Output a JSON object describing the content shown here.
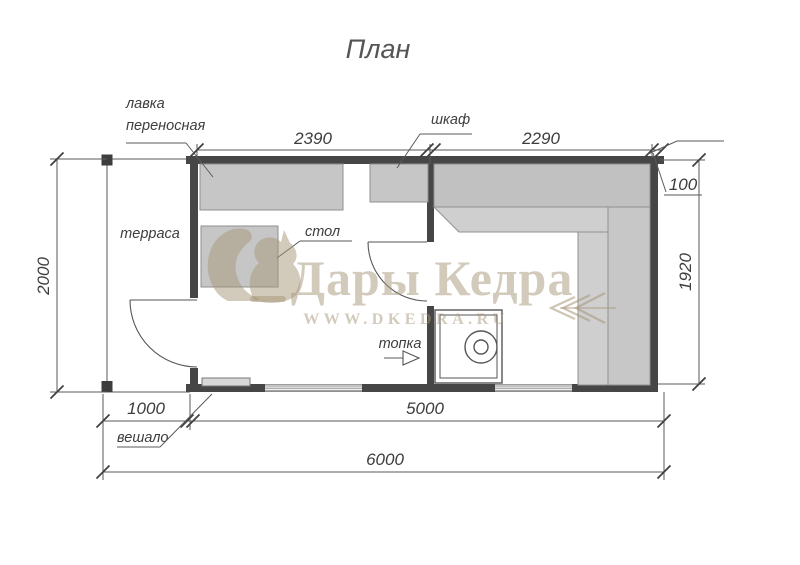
{
  "title": "План",
  "watermark": {
    "brand": "Дары Кедра",
    "site": "WWW.DKEDRA.RU",
    "color": "#a69578"
  },
  "rooms": {
    "terrace": "терраса"
  },
  "annotations": {
    "bench": {
      "line1": "лавка",
      "line2": "переносная"
    },
    "cabinet": "шкаф",
    "table": "стол",
    "firebox": "топка",
    "hanger": "вешало"
  },
  "dimensions": {
    "room1_width": "2390",
    "room2_width": "2290",
    "wall_thickness": "100",
    "room2_depth": "1920",
    "terrace_depth": "2000",
    "terrace_width": "1000",
    "building_length": "5000",
    "total_length": "6000"
  },
  "colors": {
    "wall": "#464646",
    "furniture": "#c6c6c6",
    "bench_dark": "#c1c1c1",
    "bench_light": "#cfcfcf"
  }
}
